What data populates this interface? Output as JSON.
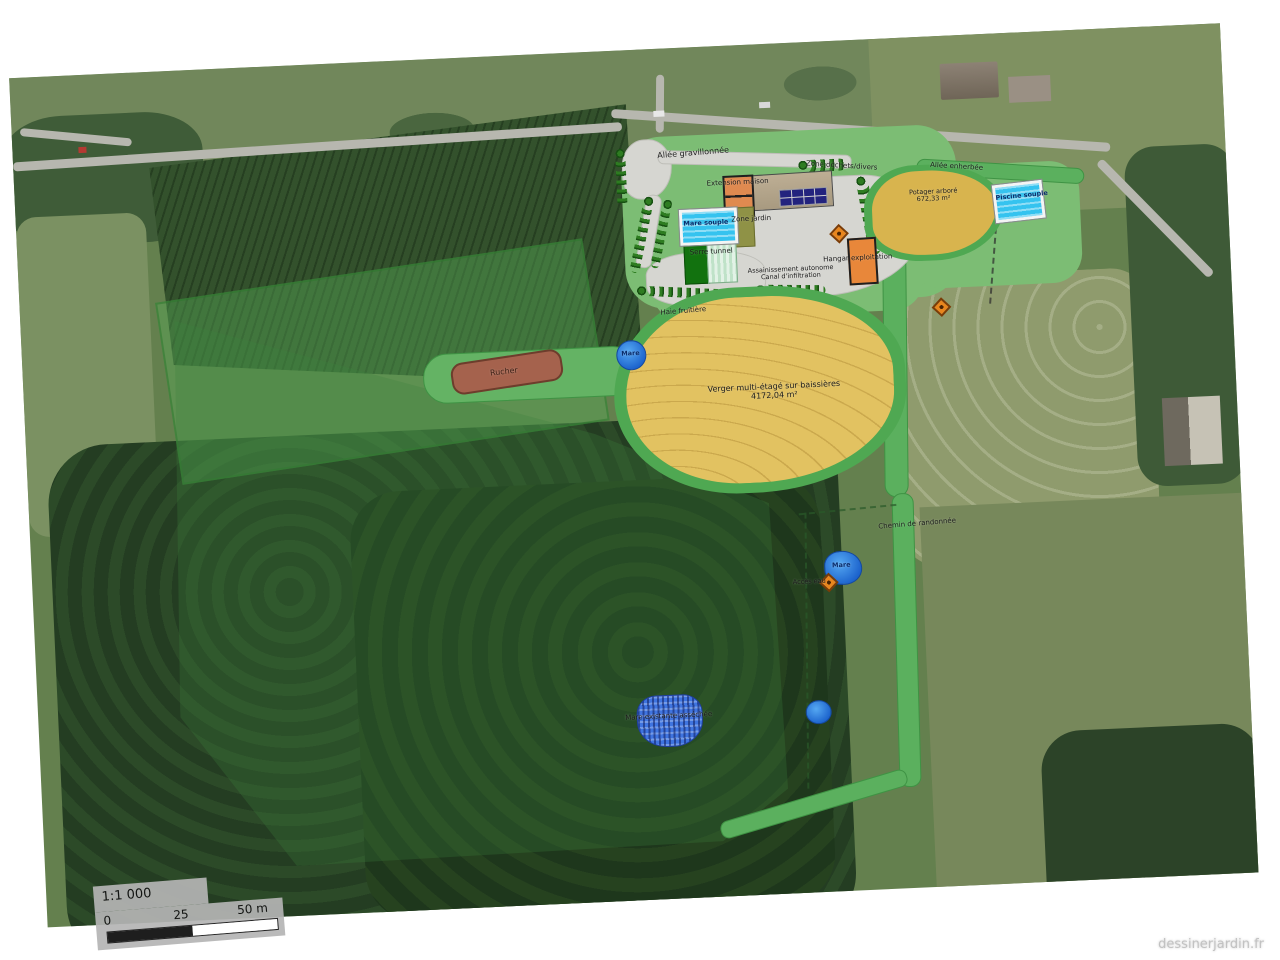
{
  "watermark": "dessinerjardin.fr",
  "scalebar": {
    "ratio": "1:1 000",
    "t0": "0",
    "t25": "25",
    "t50": "50 m"
  },
  "labels": {
    "allee_gravillonnee": "Allée gravillonnée",
    "zone_dechets": "Zone déchets/divers",
    "allee_enherbee": "Allée enherbée",
    "extension_maison": "Extension maison",
    "potager_arbore": "Potager arboré",
    "potager_arbore_area": "672,33 m²",
    "mare_souple": "Mare souple",
    "zone_jardin": "Zone jardin",
    "piscine_souple": "Piscine souple",
    "serre_tunnel": "Serre tunnel",
    "assainissement_1": "Assainissement autonome",
    "assainissement_2": "Canal d'infiltration",
    "hangar_exploitation": "Hangar exploitation",
    "haie_fruitiere": "Haie fruitière",
    "mare_top": "Mare",
    "rucher": "Rucher",
    "verger": "Verger multi-étagé sur baissières",
    "verger_area": "4172,04 m²",
    "chemin_randonnee": "Chemin de randonnée",
    "mare_mid": "Mare",
    "acces_eau": "Accès eau",
    "mare_existante": "Mare existante asséchée"
  },
  "colors": {
    "verger_fill": "#e2c261",
    "potager_fill": "#d8b44e",
    "lawn": "#7cbd74",
    "grass_band": "#5bb05e",
    "hedge": "#2e7c21",
    "pool_water": "#35c3ef",
    "pond_water": "#1b62cc",
    "building_orange": "#e8873a",
    "roof_tan": "#b4a58b",
    "rucher_brown": "#a5624d",
    "gravel": "#d6d6d1"
  }
}
